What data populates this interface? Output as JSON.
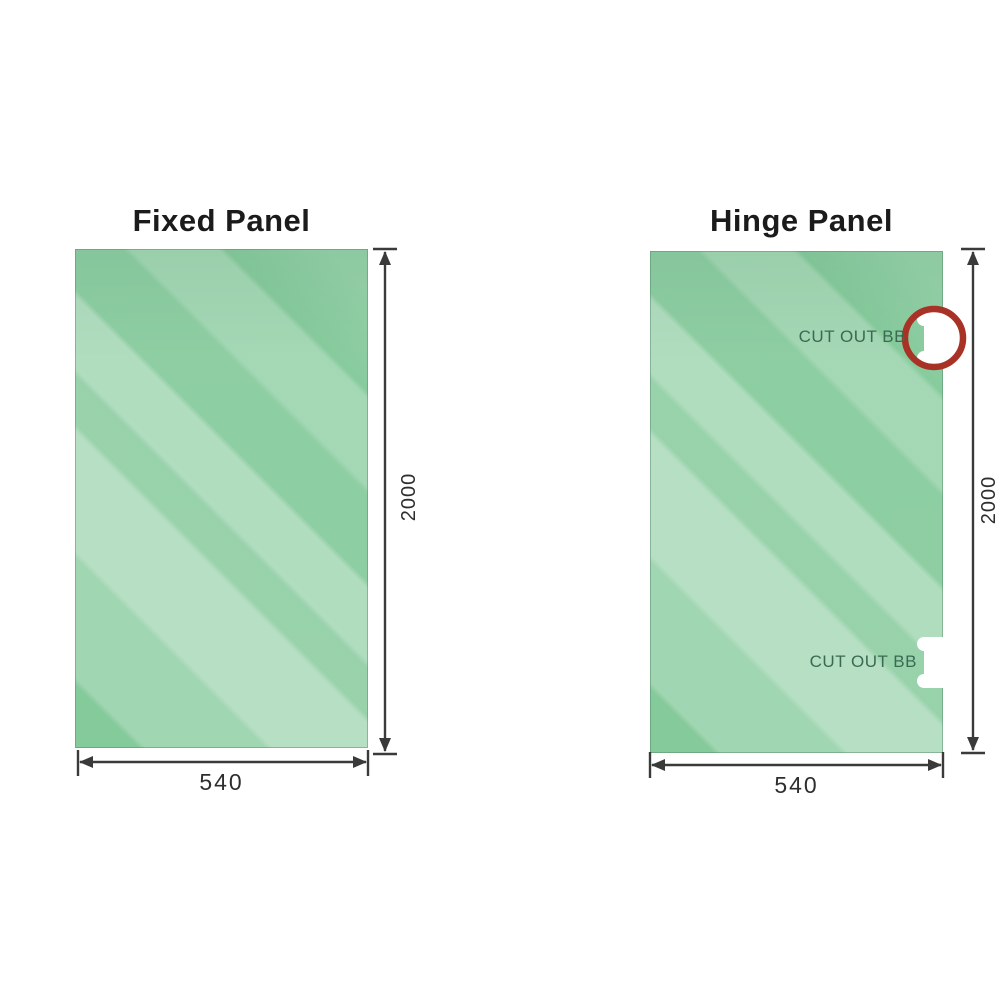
{
  "document": {
    "type": "shower-screen glass panel specification diagram",
    "background": "#ffffff"
  },
  "diagrams": [
    {
      "title": "Fixed Panel",
      "height_label": "2000",
      "width_label": "540",
      "cutouts": []
    },
    {
      "title": "Hinge Panel",
      "height_label": "2000",
      "width_label": "540",
      "cutouts": [
        {
          "label": "CUT OUT BB",
          "highlighted": true
        },
        {
          "label": "CUT OUT BB",
          "highlighted": false
        }
      ]
    }
  ],
  "colors": {
    "glass_green": "#85ca9b",
    "glass_streak_light": "#b8e4c6",
    "dimension_line": "#3a3a3a",
    "title_text": "#1b1b1b",
    "cutout_label_text": "#3a6a52",
    "highlight_ring_red": "#a93226",
    "cutout_fill": "#ffffff"
  }
}
